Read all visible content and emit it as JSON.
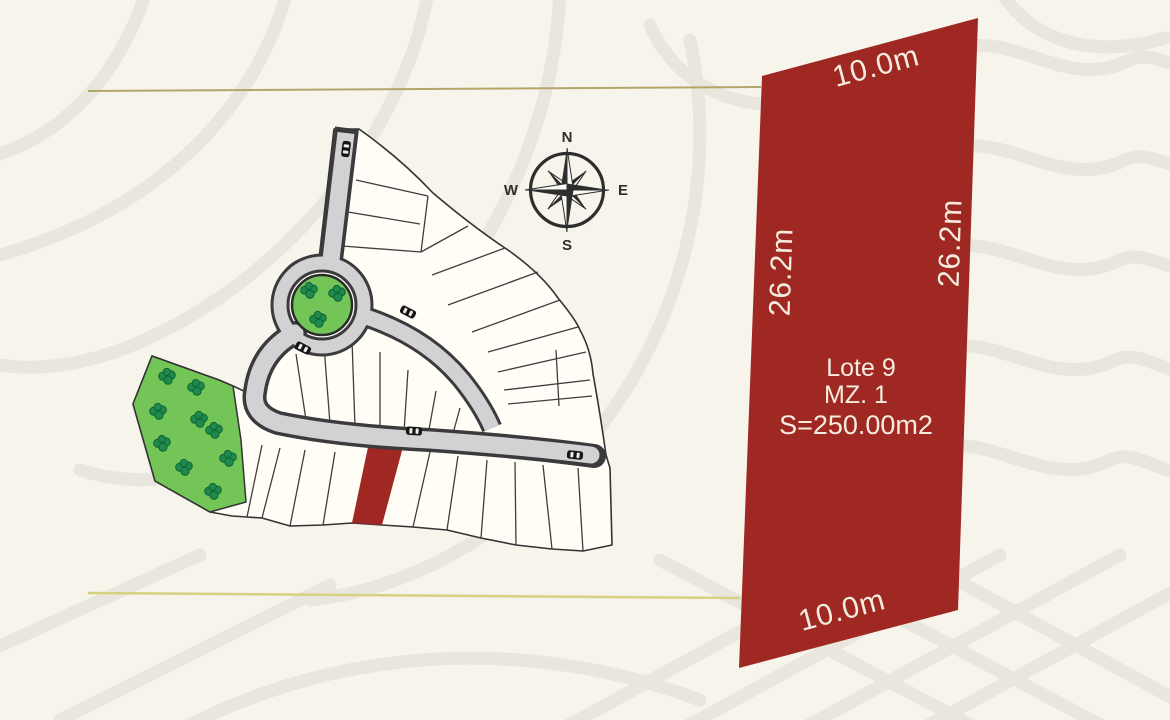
{
  "colors": {
    "background": "#f7f4ec",
    "wave_pattern": "#e9e6de",
    "guide_line_top": "#b3a66b",
    "guide_line_bottom": "#d6d27f",
    "highlight_red": "#9f2823",
    "road_fill": "#d2d2d4",
    "road_border": "#3b3b3d",
    "lot_fill": "#fffdf6",
    "park_green": "#74c557",
    "tree_green": "#1f8a4d",
    "card_text": "#f3ecdf"
  },
  "compass": {
    "n": "N",
    "e": "E",
    "s": "S",
    "w": "W"
  },
  "lot_card": {
    "top_dim": "10.0m",
    "bottom_dim": "10.0m",
    "left_dim": "26.2m",
    "right_dim": "26.2m",
    "name": "Lote 9",
    "block": "MZ. 1",
    "area": "S=250.00m2"
  }
}
